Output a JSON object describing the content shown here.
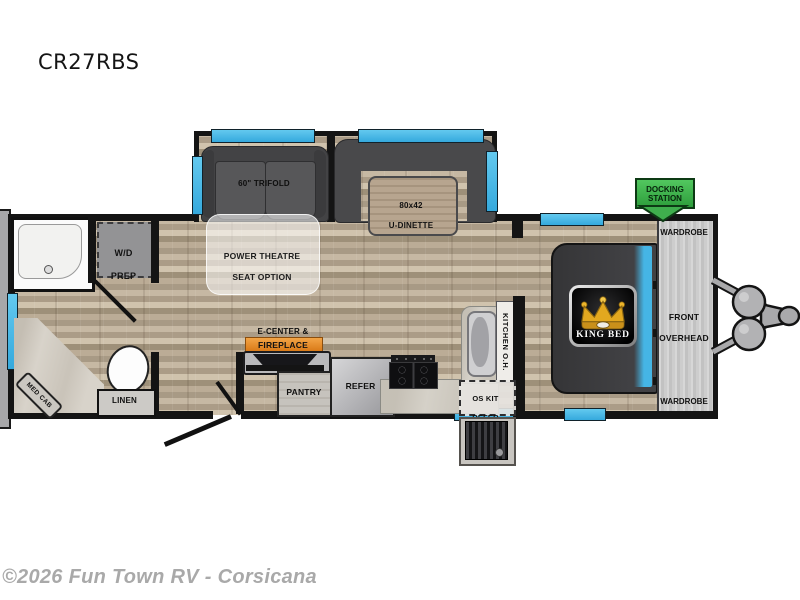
{
  "title": "CR27RBS",
  "watermark": "©2026 Fun Town RV - Corsicana",
  "labels": {
    "trifold": "60\" TRIFOLD",
    "dinette1": "80x42",
    "dinette2": "U-DINETTE",
    "theatre1": "POWER THEATRE",
    "theatre2": "SEAT OPTION",
    "wd1": "W/D",
    "wd2": "PREP",
    "medcab": "MED CAB",
    "linen": "LINEN",
    "ecenter": "E-CENTER &",
    "fireplace": "FIREPLACE",
    "pantry": "PANTRY",
    "refer": "REFER",
    "kitchen_oh": "KITCHEN O.H.",
    "oskit1": "OS KIT",
    "oskit2": "REFER",
    "kingbed": "KING BED",
    "wardrobe_top": "WARDROBE",
    "front1": "FRONT",
    "front2": "OVERHEAD",
    "wardrobe_bottom": "WARDROBE",
    "docking1": "DOCKING",
    "docking2": "STATION"
  },
  "colors": {
    "wall": "#141414",
    "window_blue": "#49b8e6",
    "docking_green": "#3fae4d",
    "fireplace_orange": "#e8871e",
    "floor_wood": "#b1a28e",
    "crown_gold": "#eeb62b",
    "bed_dark": "#39393b"
  }
}
